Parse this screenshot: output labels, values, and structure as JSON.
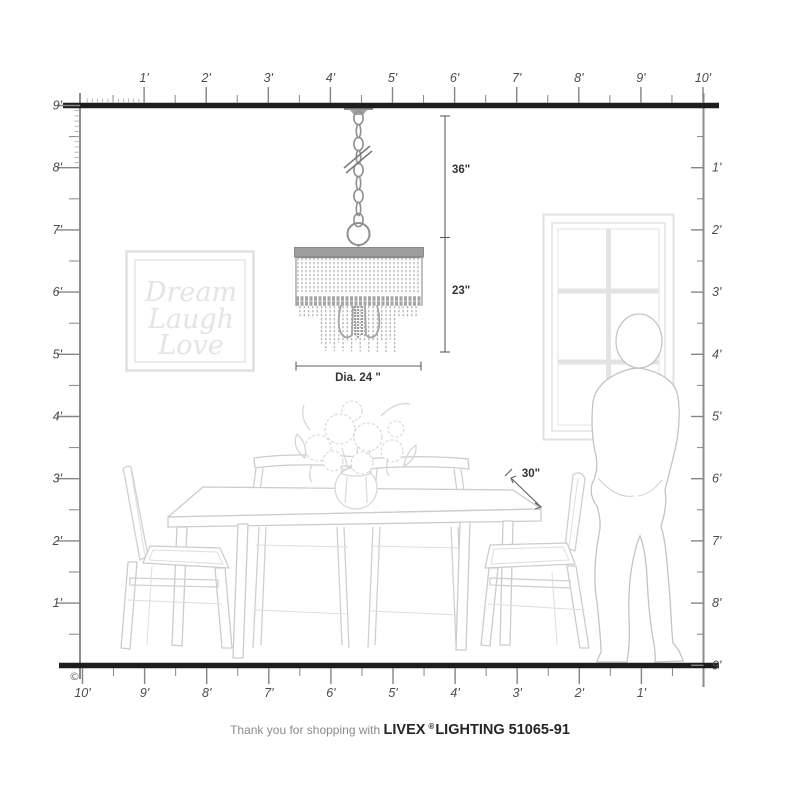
{
  "rulers": {
    "top": [
      "1'",
      "2'",
      "3'",
      "4'",
      "5'",
      "6'",
      "7'",
      "8'",
      "9'",
      "10'"
    ],
    "left": [
      "9'",
      "8'",
      "7'",
      "6'",
      "5'",
      "4'",
      "3'",
      "2'",
      "1'"
    ],
    "right": [
      "1'",
      "2'",
      "3'",
      "4'",
      "5'",
      "6'",
      "7'",
      "8'",
      "9'"
    ],
    "bottom": [
      "10'",
      "9'",
      "8'",
      "7'",
      "6'",
      "5'",
      "4'",
      "3'",
      "2'",
      "1'"
    ]
  },
  "annotations": {
    "hang_height": "36\"",
    "fixture_height": "23\"",
    "fixture_diameter": "Dia. 24 \"",
    "table_depth": "30\""
  },
  "wall_art": {
    "line1": "Dream",
    "line2": "Laugh",
    "line3": "Love"
  },
  "footer": {
    "prefix": "Thank you for shopping with",
    "brand": "LIVEX",
    "registered": "®",
    "suffix": "LIGHTING 51065-91"
  },
  "copyright_symbol": "©",
  "colors": {
    "structure_bar": "#1d1d1d",
    "ruler_line": "#8c8c8c",
    "dimension_text": "#333333",
    "furniture_line": "#d0d0d0",
    "fixture_line": "#8f8f8f",
    "art_text": "#e4e4e4"
  }
}
